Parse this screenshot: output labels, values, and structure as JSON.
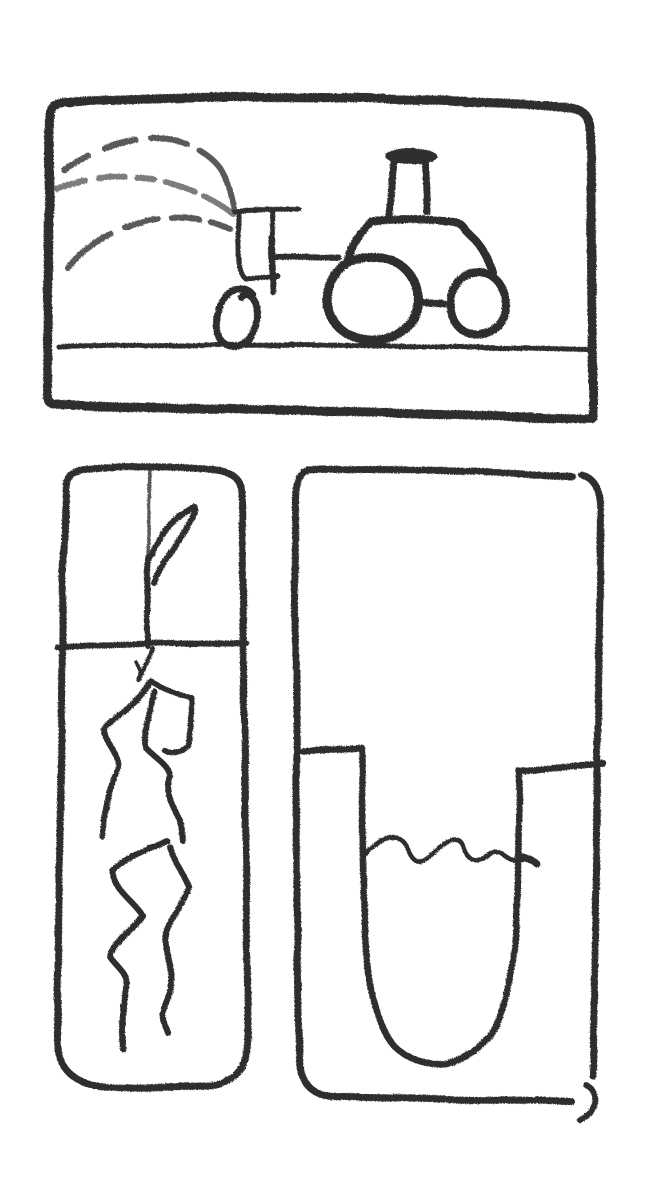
{
  "colors": {
    "background": "#ffffff",
    "ink": "#2f2f2f"
  },
  "scene": {
    "kind": "hand-drawn pencil sketch, three panels",
    "label": "Three-panel pencil sketch: tractor spraying a field; seedling with roots in soil; shaft with underground water level"
  },
  "panels": [
    {
      "name": "tractor-spraying-field",
      "label": "Tractor with sprayer tank shooting dashed spray arcs over a field",
      "glyphs": [
        "panel-border",
        "spray-arc-top",
        "spray-arc-middle",
        "spray-arc-bottom",
        "sprayer-tank",
        "hitch",
        "front-wheel",
        "rear-wheel",
        "back-wheel",
        "axle",
        "cab",
        "exhaust-stack",
        "ground-line"
      ]
    },
    {
      "name": "seedling-and-roots",
      "label": "Tall panel: seedling stem and leaf above a soil line, wavy roots reaching down below",
      "glyphs": [
        "panel-border",
        "soil-line",
        "stem",
        "leaf",
        "root-junction",
        "root-branch",
        "roots"
      ]
    },
    {
      "name": "underground-water-level",
      "label": "Tall panel: U-shaped shaft between two ledges with a wavy water level inside",
      "glyphs": [
        "panel-border",
        "shaft-walls",
        "water-line",
        "corner-hook"
      ]
    }
  ]
}
